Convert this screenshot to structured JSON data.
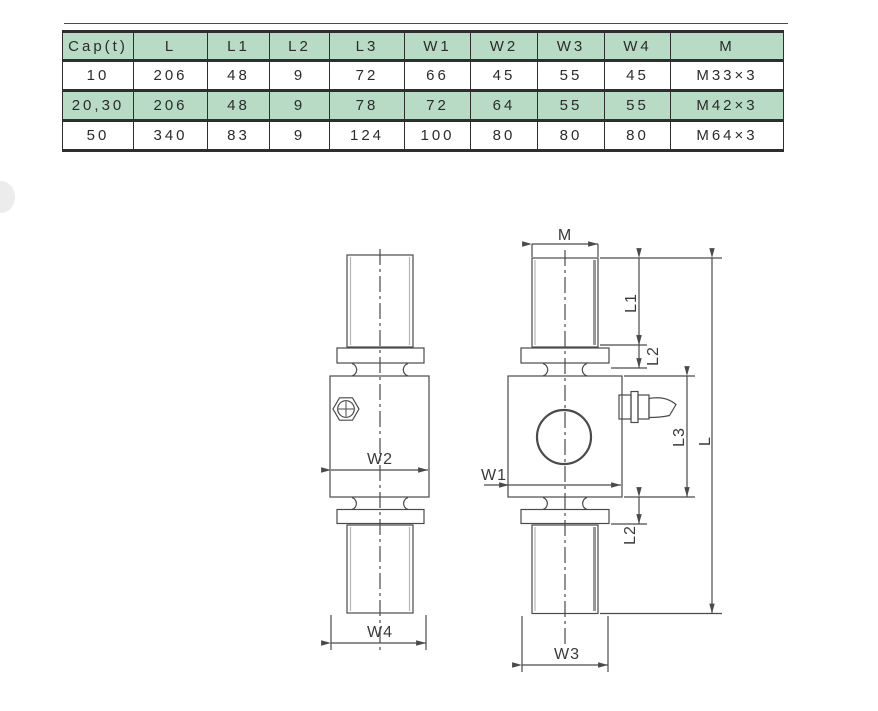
{
  "table": {
    "columns": [
      "Cap(t)",
      "L",
      "L1",
      "L2",
      "L3",
      "W1",
      "W2",
      "W3",
      "W4",
      "M"
    ],
    "rows": [
      [
        "10",
        "206",
        "48",
        "9",
        "72",
        "66",
        "45",
        "55",
        "45",
        "M33×3"
      ],
      [
        "20,30",
        "206",
        "48",
        "9",
        "78",
        "72",
        "64",
        "55",
        "55",
        "M42×3"
      ],
      [
        "50",
        "340",
        "83",
        "9",
        "124",
        "100",
        "80",
        "80",
        "80",
        "M64×3"
      ]
    ],
    "highlighted_rows": [
      1
    ],
    "header_bg": "#b8dbc6",
    "highlight_bg": "#b8dbc6"
  },
  "diagram": {
    "labels": {
      "m": "M",
      "l1": "L1",
      "l2_upper": "L2",
      "l3": "L3",
      "l": "L",
      "l2_lower": "L2",
      "w1": "W1",
      "w2": "W2",
      "w3": "W3",
      "w4": "W4"
    },
    "line_color": "#4a4a4a"
  }
}
